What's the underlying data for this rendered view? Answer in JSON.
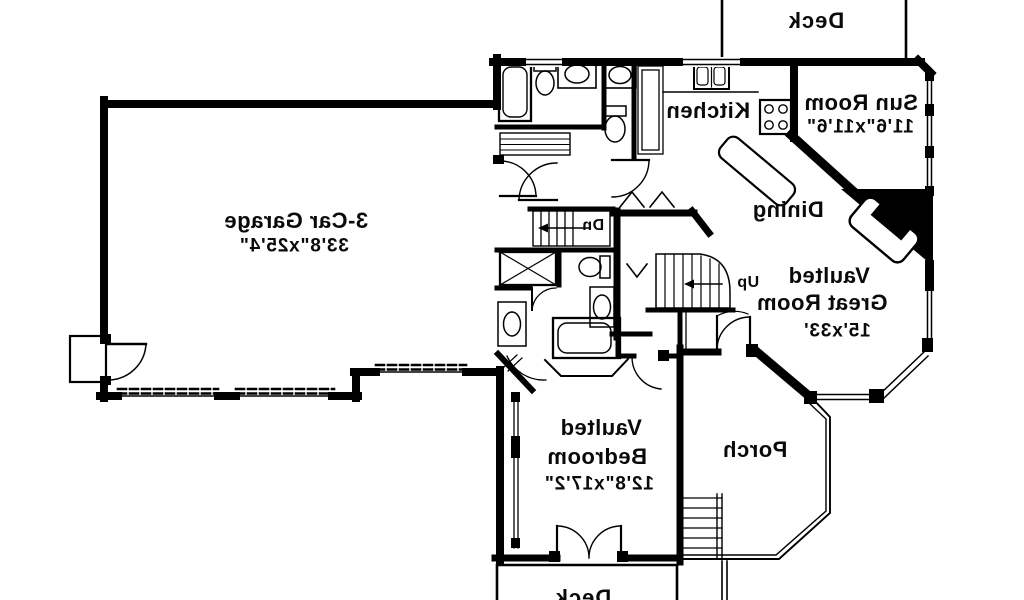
{
  "plan": {
    "colors": {
      "ink": "#000000",
      "paper": "#ffffff"
    },
    "rooms": {
      "deck_top": {
        "label": "Deck"
      },
      "sun_room": {
        "label": "Sun Room",
        "dims": "11'6\"x11'6\""
      },
      "kitchen": {
        "label": "Kitchen"
      },
      "dining": {
        "label": "Dining"
      },
      "garage": {
        "label": "3-Car Garage",
        "dims": "33'8\"x25'4\""
      },
      "great_room": {
        "line1": "Vaulted",
        "line2": "Great Room",
        "dims": "15'x33'"
      },
      "bedroom": {
        "line1": "Vaulted",
        "line2": "Bedroom",
        "dims": "12'8\"x17'2\""
      },
      "porch": {
        "label": "Porch"
      },
      "deck_bottom": {
        "label": "Deck"
      }
    },
    "stairs": {
      "up_label": "Up",
      "down_label": "Dn"
    }
  }
}
